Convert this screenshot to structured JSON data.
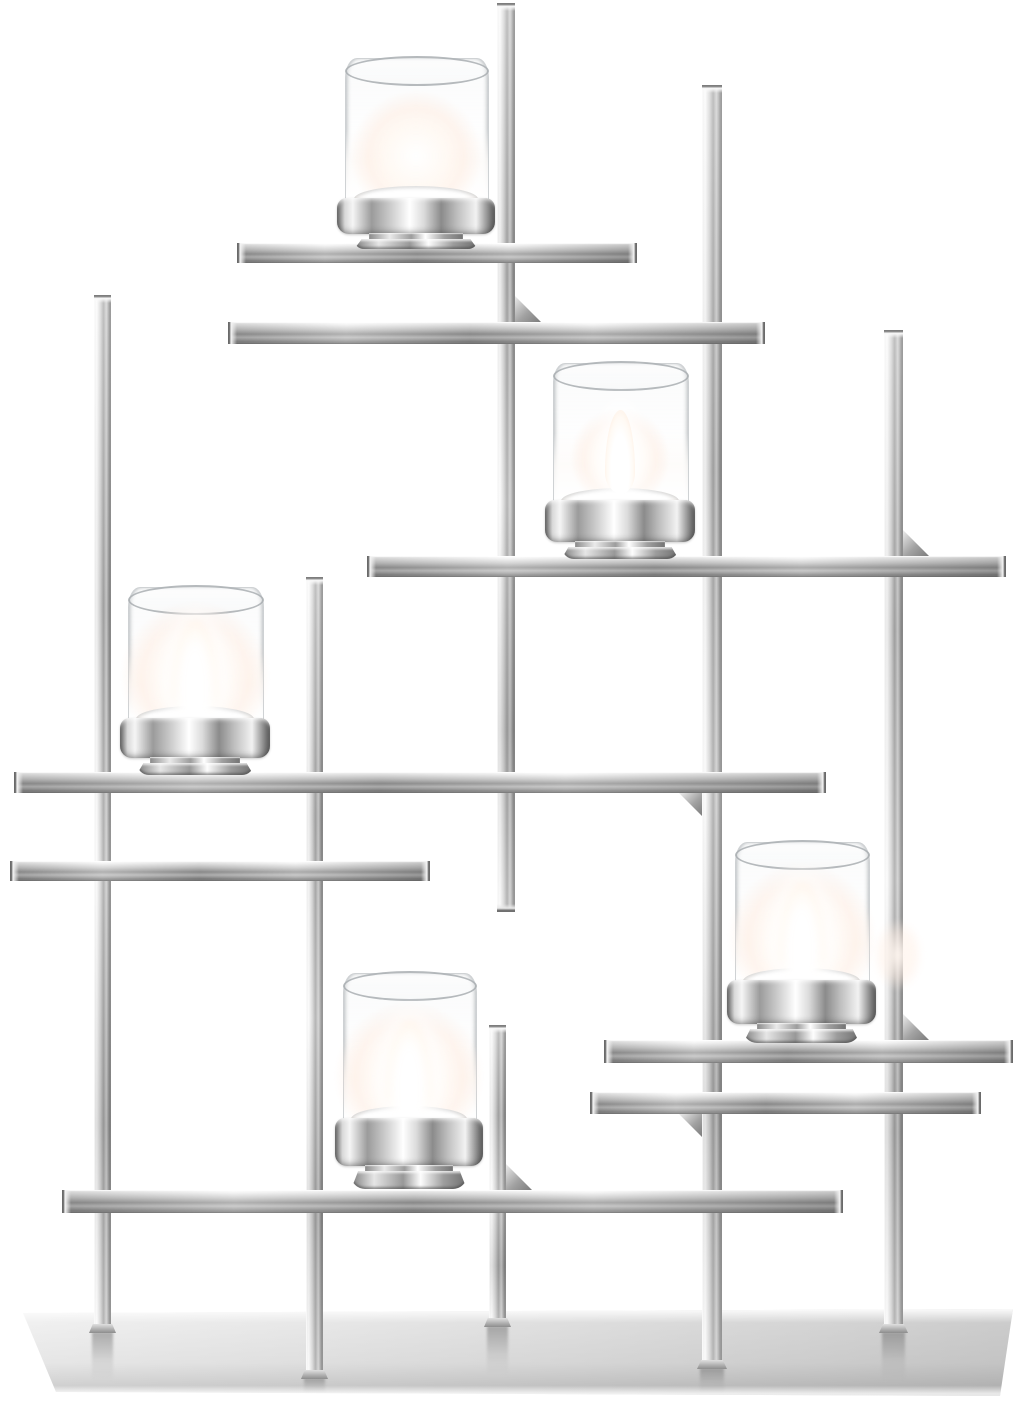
{
  "meta": {
    "type": "product-photo",
    "subject": "Modern polished chrome candelabra with geometric lattice frame and five lit tealight candles in clear glass votive cups",
    "background_color": "#ffffff",
    "width": 1023,
    "height": 1402,
    "candle_count": 5,
    "material": "polished stainless steel / chrome, clear glass"
  },
  "palette": {
    "background": "#ffffff",
    "chrome_highlight": "#fafafa",
    "chrome_mid": "#c8c8c8",
    "chrome_shadow": "#8f8f8f",
    "chrome_deep": "#5f5f5f",
    "glass_outline": "#a8adb0",
    "frost_white": "#fdfbf9",
    "flame_core": "#ffffff",
    "flame_warm": "#ffd6b9",
    "plate_light": "#f0f0f0",
    "plate_dark": "#cbcbcb"
  },
  "scene": {
    "base_plate": {
      "x": 23,
      "y": 1309,
      "w": 993,
      "h": 87,
      "points_local": [
        [
          0,
          4
        ],
        [
          990,
          0
        ],
        [
          977,
          87
        ],
        [
          33,
          83
        ]
      ]
    },
    "vertical_bars": [
      {
        "id": "post-left",
        "x": 94,
        "w": 17,
        "y1": 295,
        "y2": 1332,
        "foot": true,
        "bottom_cap": false
      },
      {
        "id": "post-left-inner",
        "x": 306,
        "w": 17,
        "y1": 577,
        "y2": 1378,
        "foot": true,
        "bottom_cap": false
      },
      {
        "id": "post-center-upper",
        "x": 497,
        "w": 18,
        "y1": 3,
        "y2": 912,
        "foot": false,
        "bottom_cap": true
      },
      {
        "id": "post-center-lower",
        "x": 489,
        "w": 17,
        "y1": 1025,
        "y2": 1326,
        "foot": true,
        "bottom_cap": false
      },
      {
        "id": "post-right-inner",
        "x": 702,
        "w": 20,
        "y1": 85,
        "y2": 1368,
        "foot": true,
        "bottom_cap": false
      },
      {
        "id": "post-right",
        "x": 884,
        "w": 19,
        "y1": 330,
        "y2": 1332,
        "foot": true,
        "bottom_cap": false
      }
    ],
    "horizontal_bars": [
      {
        "id": "shelf-top-candle",
        "y": 243,
        "h": 20,
        "x1": 237,
        "x2": 637
      },
      {
        "id": "rail-upper",
        "y": 322,
        "h": 22,
        "x1": 228,
        "x2": 765
      },
      {
        "id": "shelf-upper-right-candle",
        "y": 556,
        "h": 21,
        "x1": 367,
        "x2": 1006
      },
      {
        "id": "shelf-left-candle",
        "y": 772,
        "h": 21,
        "x1": 14,
        "x2": 826
      },
      {
        "id": "rail-left",
        "y": 861,
        "h": 20,
        "x1": 10,
        "x2": 430
      },
      {
        "id": "shelf-right-candle",
        "y": 1040,
        "h": 23,
        "x1": 604,
        "x2": 1013
      },
      {
        "id": "rail-lower-right",
        "y": 1092,
        "h": 22,
        "x1": 590,
        "x2": 981
      },
      {
        "id": "shelf-bottom-candle",
        "y": 1190,
        "h": 23,
        "x1": 62,
        "x2": 843
      }
    ],
    "brackets": [
      {
        "id": "bracket-1",
        "x": 515,
        "y": 322,
        "size": 26,
        "orient": "above-right"
      },
      {
        "id": "bracket-2",
        "x": 903,
        "y": 556,
        "size": 26,
        "orient": "above-right"
      },
      {
        "id": "bracket-3",
        "x": 702,
        "y": 793,
        "size": 23,
        "orient": "below-left"
      },
      {
        "id": "bracket-4",
        "x": 903,
        "y": 1040,
        "size": 26,
        "orient": "above-right"
      },
      {
        "id": "bracket-5",
        "x": 702,
        "y": 1114,
        "size": 23,
        "orient": "below-left"
      },
      {
        "id": "bracket-6",
        "x": 506,
        "y": 1190,
        "size": 26,
        "orient": "above-right"
      }
    ],
    "candles": [
      {
        "id": "candle-top",
        "glass_x": 345,
        "glass_y": 58,
        "glass_w": 142,
        "holder_top": 198,
        "ring_h": 36,
        "foot_h": 14,
        "flame": "glow"
      },
      {
        "id": "candle-upper-right",
        "glass_x": 553,
        "glass_y": 363,
        "glass_w": 134,
        "holder_top": 500,
        "ring_h": 42,
        "foot_h": 16,
        "flame": "teardrop"
      },
      {
        "id": "candle-left",
        "glass_x": 128,
        "glass_y": 587,
        "glass_w": 134,
        "holder_top": 718,
        "ring_h": 40,
        "foot_h": 16,
        "flame": "blaze"
      },
      {
        "id": "candle-bottom",
        "glass_x": 343,
        "glass_y": 973,
        "glass_w": 132,
        "holder_top": 1118,
        "ring_h": 48,
        "foot_h": 22,
        "flame": "blaze"
      },
      {
        "id": "candle-right",
        "glass_x": 735,
        "glass_y": 842,
        "glass_w": 133,
        "holder_top": 980,
        "ring_h": 44,
        "foot_h": 18,
        "flame": "blaze"
      }
    ],
    "glint": {
      "x": 872,
      "y": 918,
      "w": 52,
      "h": 74
    }
  }
}
